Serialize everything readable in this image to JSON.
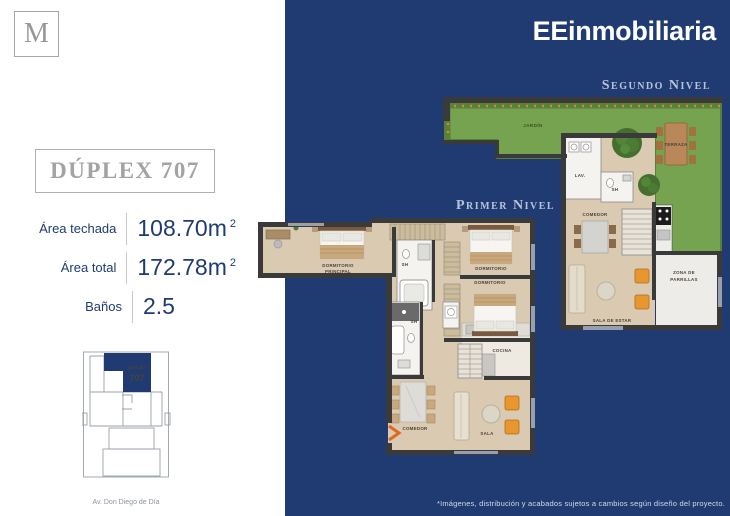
{
  "brand": {
    "monogram": "M",
    "name": "EEinmobiliaria"
  },
  "colors": {
    "navy": "#1f3b72",
    "accent_orange": "#e8962e",
    "garden_green": "#76a34f"
  },
  "unit": {
    "title": "DÚPLEX 707",
    "specs": [
      {
        "label": "Área techada",
        "value": "108.70m",
        "sup": "2"
      },
      {
        "label": "Área total",
        "value": "172.78m",
        "sup": "2"
      },
      {
        "label": "Baños",
        "value": "2.5",
        "sup": ""
      }
    ],
    "sitemap": {
      "unit_line1": "DÚPLEX",
      "unit_line2": "707",
      "street": "Av. Don Diego de Día"
    }
  },
  "levels": {
    "second": {
      "title": "Segundo Nivel",
      "rooms": {
        "jardin": "JARDÍN",
        "terraza": "TERRAZA",
        "lav": "LAV.",
        "sh": "SH",
        "comedor": "COMEDOR",
        "zona_line1": "ZONA DE",
        "zona_line2": "PARRILLAS",
        "sala_estar": "SALA DE ESTAR"
      }
    },
    "first": {
      "title": "Primer Nivel",
      "rooms": {
        "dorm_principal_line1": "DORMITORIO",
        "dorm_principal_line2": "PRINCIPAL",
        "dormitorio_1": "DORMITORIO",
        "dormitorio_2": "DORMITORIO",
        "sh_1": "SH",
        "sh_2": "SH",
        "cocina": "COCINA",
        "comedor": "COMEDOR",
        "sala": "SALA"
      }
    }
  },
  "footer": {
    "disclaimer": "*Imágenes, distribución y acabados sujetos a cambios según diseño del proyecto."
  }
}
